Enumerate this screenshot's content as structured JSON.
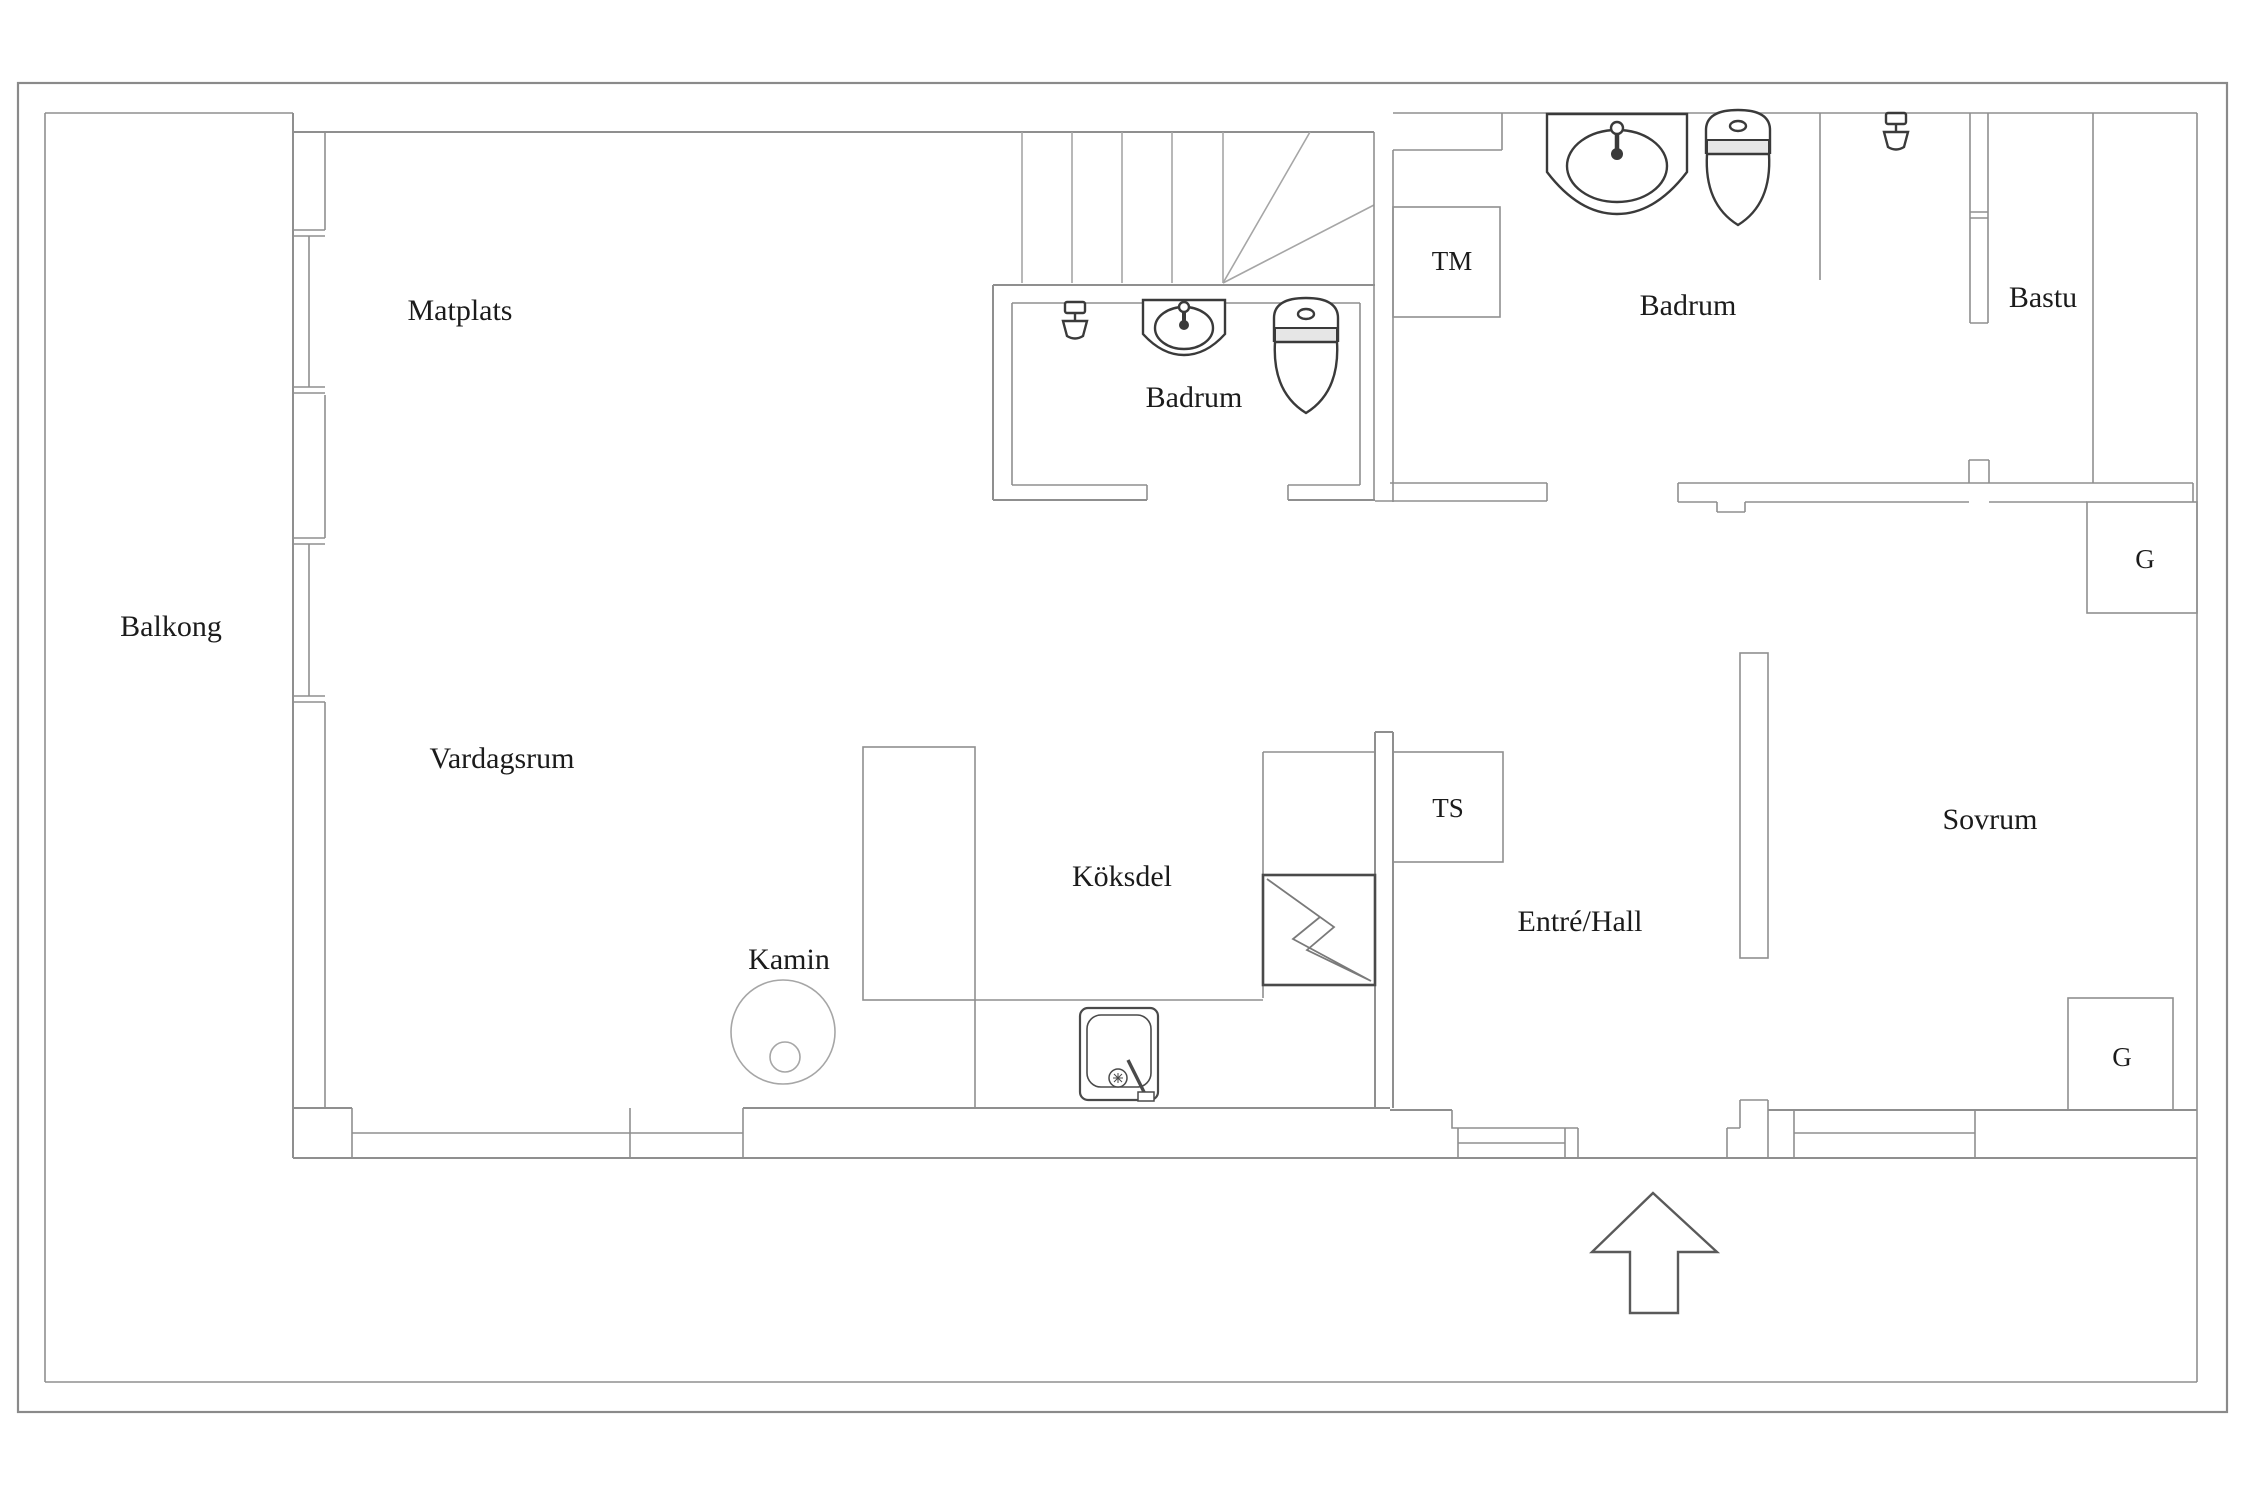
{
  "floorplan": {
    "type": "apartment-floor-plan",
    "language": "Swedish",
    "labels": [
      {
        "name": "matplats",
        "text": "Matplats",
        "x": 460,
        "y": 320,
        "size": 30
      },
      {
        "name": "badrum-1",
        "text": "Badrum",
        "x": 1194,
        "y": 407,
        "size": 30
      },
      {
        "name": "tm",
        "text": "TM",
        "x": 1452,
        "y": 270,
        "size": 27
      },
      {
        "name": "badrum-2",
        "text": "Badrum",
        "x": 1688,
        "y": 315,
        "size": 30
      },
      {
        "name": "bastu",
        "text": "Bastu",
        "x": 2043,
        "y": 307,
        "size": 30
      },
      {
        "name": "balkong",
        "text": "Balkong",
        "x": 171,
        "y": 636,
        "size": 30
      },
      {
        "name": "g-top",
        "text": "G",
        "x": 2145,
        "y": 568,
        "size": 27
      },
      {
        "name": "vardagsrum",
        "text": "Vardagsrum",
        "x": 502,
        "y": 768,
        "size": 30
      },
      {
        "name": "koksdel",
        "text": "Köksdel",
        "x": 1122,
        "y": 886,
        "size": 30
      },
      {
        "name": "kamin",
        "text": "Kamin",
        "x": 789,
        "y": 969,
        "size": 30
      },
      {
        "name": "ts",
        "text": "TS",
        "x": 1448,
        "y": 817,
        "size": 27
      },
      {
        "name": "entre-hall",
        "text": "Entré/Hall",
        "x": 1580,
        "y": 931,
        "size": 30
      },
      {
        "name": "sovrum",
        "text": "Sovrum",
        "x": 1990,
        "y": 829,
        "size": 30
      },
      {
        "name": "g-bottom",
        "text": "G",
        "x": 2122,
        "y": 1066,
        "size": 27
      }
    ],
    "icons": [
      "shower-icon",
      "washbasin-icon",
      "toilet-icon",
      "kitchen-sink-icon",
      "fireplace-icon",
      "electrical-panel-icon",
      "entrance-arrow-icon"
    ],
    "colors": {
      "wall": "#8f8f8f",
      "frame": "#8a8a8a",
      "fixture": "#3a3a3a",
      "light_line": "#a6a6a6",
      "text": "#1b1b1b",
      "background": "#ffffff"
    }
  }
}
